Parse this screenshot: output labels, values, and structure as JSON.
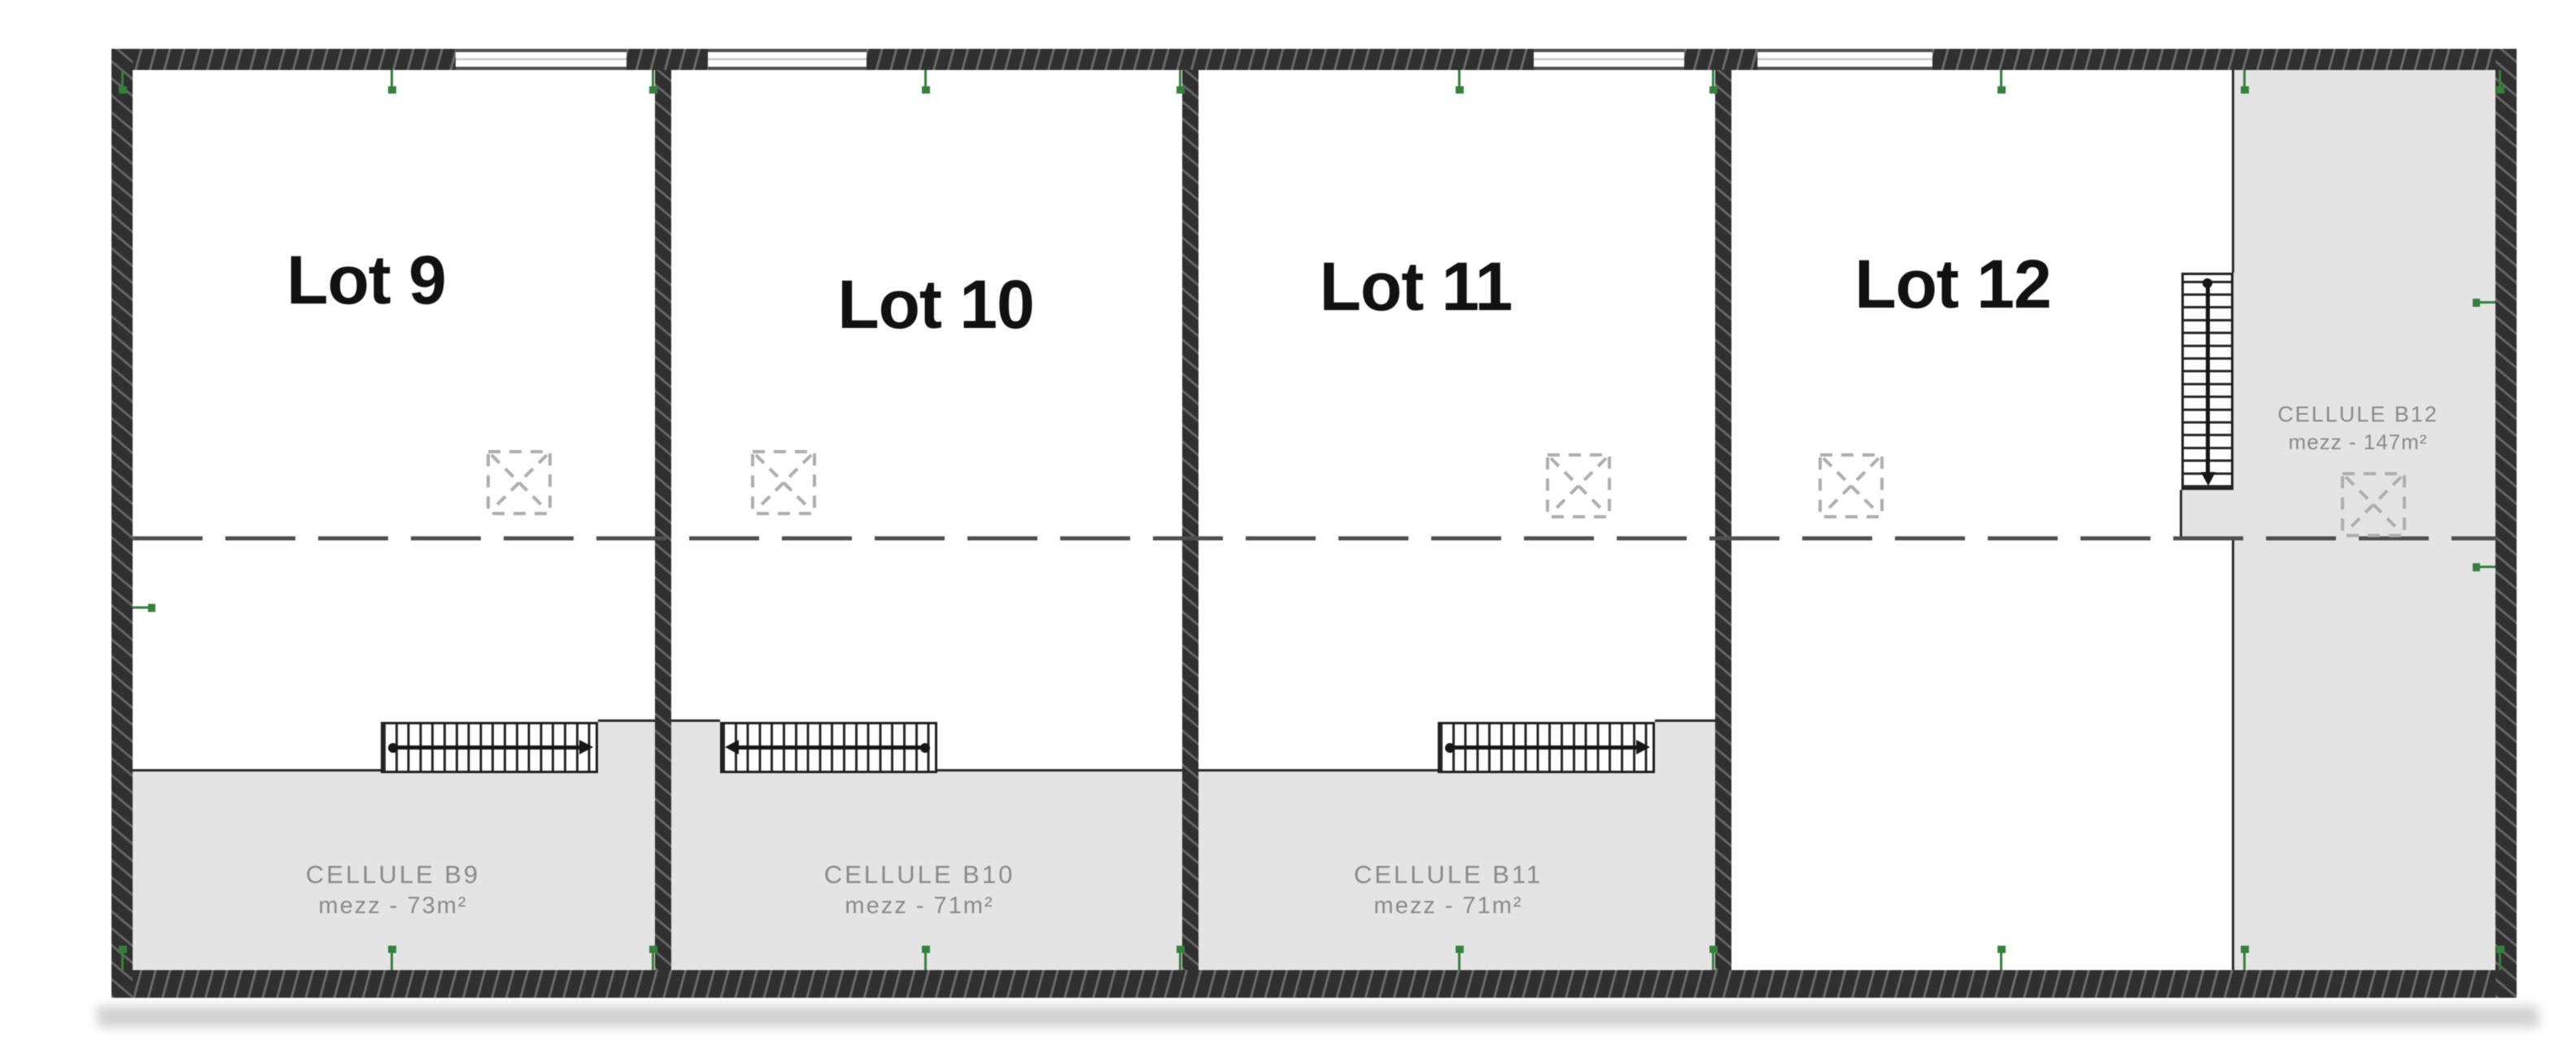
{
  "plan": {
    "title": "Mezzanine level floor plan",
    "lots": [
      {
        "id": "lot9",
        "label": "Lot 9"
      },
      {
        "id": "lot10",
        "label": "Lot 10"
      },
      {
        "id": "lot11",
        "label": "Lot 11"
      },
      {
        "id": "lot12",
        "label": "Lot 12"
      }
    ],
    "cells": [
      {
        "id": "b9",
        "name": "CELLULE B9",
        "area": "mezz - 73m²"
      },
      {
        "id": "b10",
        "name": "CELLULE B10",
        "area": "mezz - 71m²"
      },
      {
        "id": "b11",
        "name": "CELLULE B11",
        "area": "mezz - 71m²"
      },
      {
        "id": "b12",
        "name": "CELLULE B12",
        "area": "mezz - 147m²"
      }
    ],
    "colors": {
      "wall": "#303030",
      "mezzanine_fill": "#e4e4e4",
      "marker_green": "#35803b",
      "dashed_line": "#4f4f4f",
      "column_symbol": "#aeaeae",
      "label_text": "#111111",
      "cell_text": "#8a8a8a"
    }
  }
}
